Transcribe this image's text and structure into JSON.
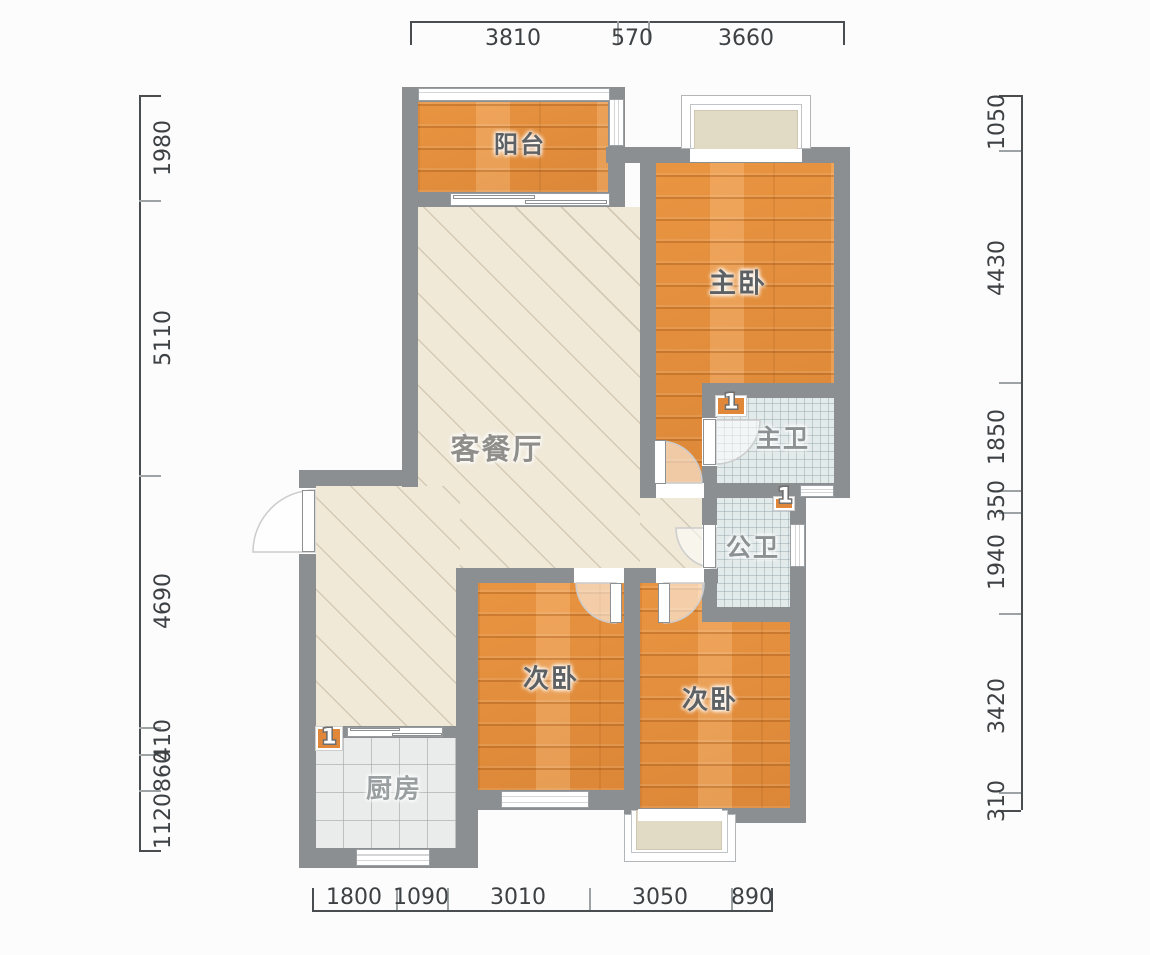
{
  "title": "apartment-floor-plan",
  "rooms": {
    "balcony": {
      "label": "阳台"
    },
    "master_bedroom": {
      "label": "主卧"
    },
    "living_dining": {
      "label": "客餐厅"
    },
    "master_bath": {
      "label": "主卫"
    },
    "public_bath": {
      "label": "公卫"
    },
    "bedroom_left": {
      "label": "次卧"
    },
    "bedroom_right": {
      "label": "次卧"
    },
    "kitchen": {
      "label": "厨房"
    }
  },
  "markers": {
    "kitchen_flue": "1",
    "master_bath_flue": "1",
    "public_bath_flue": "1"
  },
  "dimensions": {
    "top": [
      "3810",
      "570",
      "3660"
    ],
    "bottom": [
      "1800",
      "1090",
      "3010",
      "3050",
      "890"
    ],
    "left": [
      "1980",
      "5110",
      "4690",
      "410",
      "860",
      "1120"
    ],
    "right": [
      "1050",
      "4430",
      "1850",
      "350",
      "1940",
      "3420",
      "310"
    ]
  },
  "colors": {
    "wall": "#8b8f92",
    "wood_floor": "#e28d3c",
    "living_floor": "#f0e9d8",
    "bath_tile": "#e3eaea",
    "kitchen_tile": "#eaeceb",
    "bay_fill": "#e1dbc6",
    "dimension_text": "#3e4144"
  }
}
